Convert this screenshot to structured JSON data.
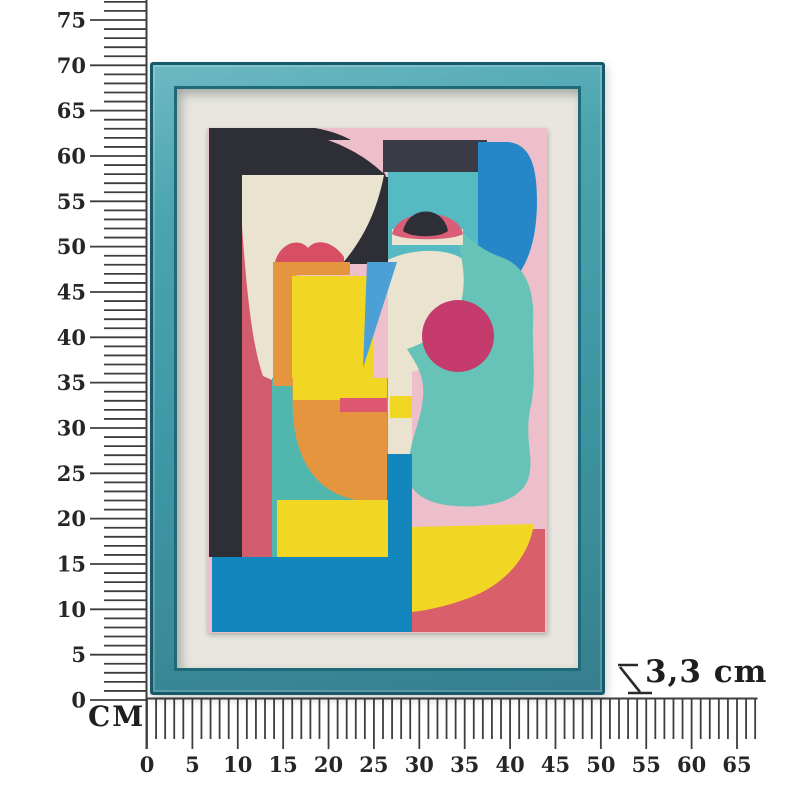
{
  "scene": {
    "description": "Product dimension photo: framed abstract cubist face wall art measured by centimeter rulers",
    "unit_label": "CM"
  },
  "rulers": {
    "vertical": {
      "tick_labels": [
        "0",
        "5",
        "10",
        "15",
        "20",
        "25",
        "30",
        "35",
        "40",
        "45",
        "50",
        "55",
        "60",
        "65",
        "70",
        "75"
      ],
      "label_step_cm": 5,
      "max_tick_cm": 77
    },
    "horizontal": {
      "tick_labels": [
        "0",
        "5",
        "10",
        "15",
        "20",
        "25",
        "30",
        "35",
        "40",
        "45",
        "50",
        "55",
        "60",
        "65"
      ],
      "label_step_cm": 5,
      "max_tick_cm": 67
    }
  },
  "depth_annotation": {
    "text": "3,3 cm"
  },
  "artwork": {
    "description": "Teal framed abstract multicolour face print on white mat",
    "palette": {
      "pink": "#edbfcb",
      "black": "#2e2f36",
      "charcoal": "#3a3b45",
      "cream": "#eae3cf",
      "rose": "#d25b6e",
      "lip_red": "#d84f63",
      "rose_light": "#dd5770",
      "eye_rose": "#d95f78",
      "orange": "#e6953f",
      "yellow": "#f1d724",
      "teal_face": "#55bac2",
      "teal_curve": "#67c2b8",
      "teal_block": "#51b7ae",
      "azure": "#2587c7",
      "azure_deep": "#1286bd",
      "blue_light": "#4da0d6",
      "magenta": "#c43b6c",
      "red": "#d95f6b"
    }
  }
}
